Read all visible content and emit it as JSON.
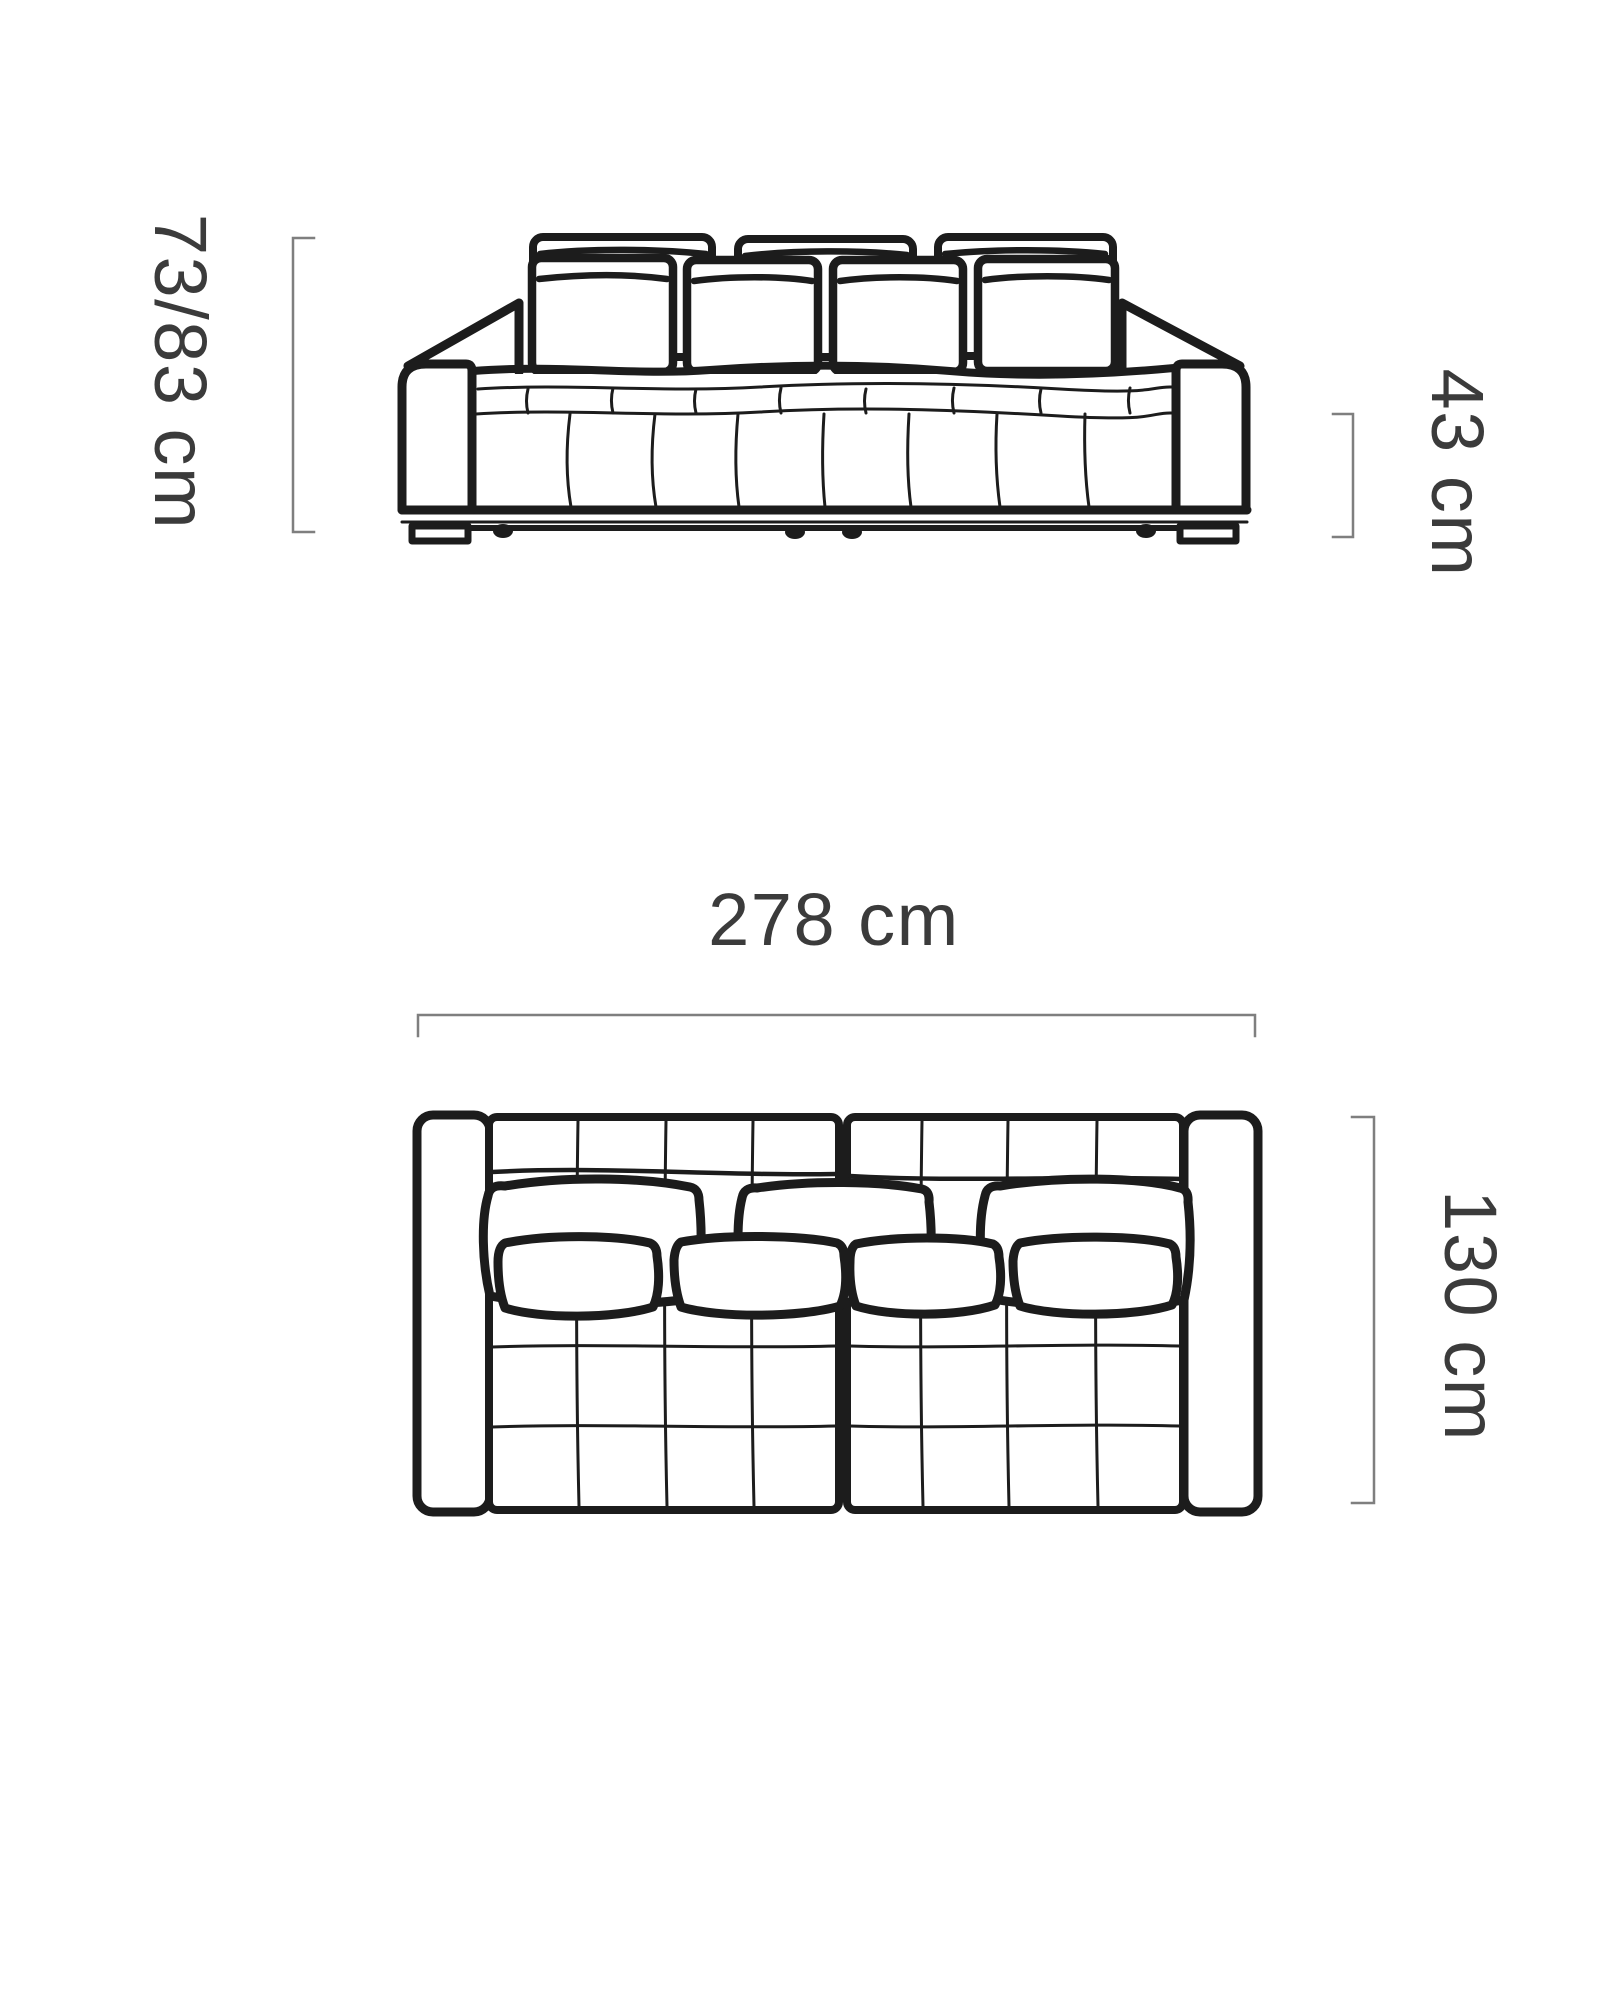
{
  "diagram": {
    "type": "furniture-dimension-drawing",
    "subject": "sofa technical drawing, front view and top view",
    "views": {
      "front": {
        "height_label": "73/83 cm",
        "seat_height_label": "43 cm"
      },
      "top": {
        "width_label": "278 cm",
        "depth_label": "130 cm"
      }
    },
    "colors": {
      "line": "#1c1c1c",
      "dimension_line": "#7f7f7f",
      "label_text": "#3b3b3b",
      "background": "#ffffff"
    }
  }
}
